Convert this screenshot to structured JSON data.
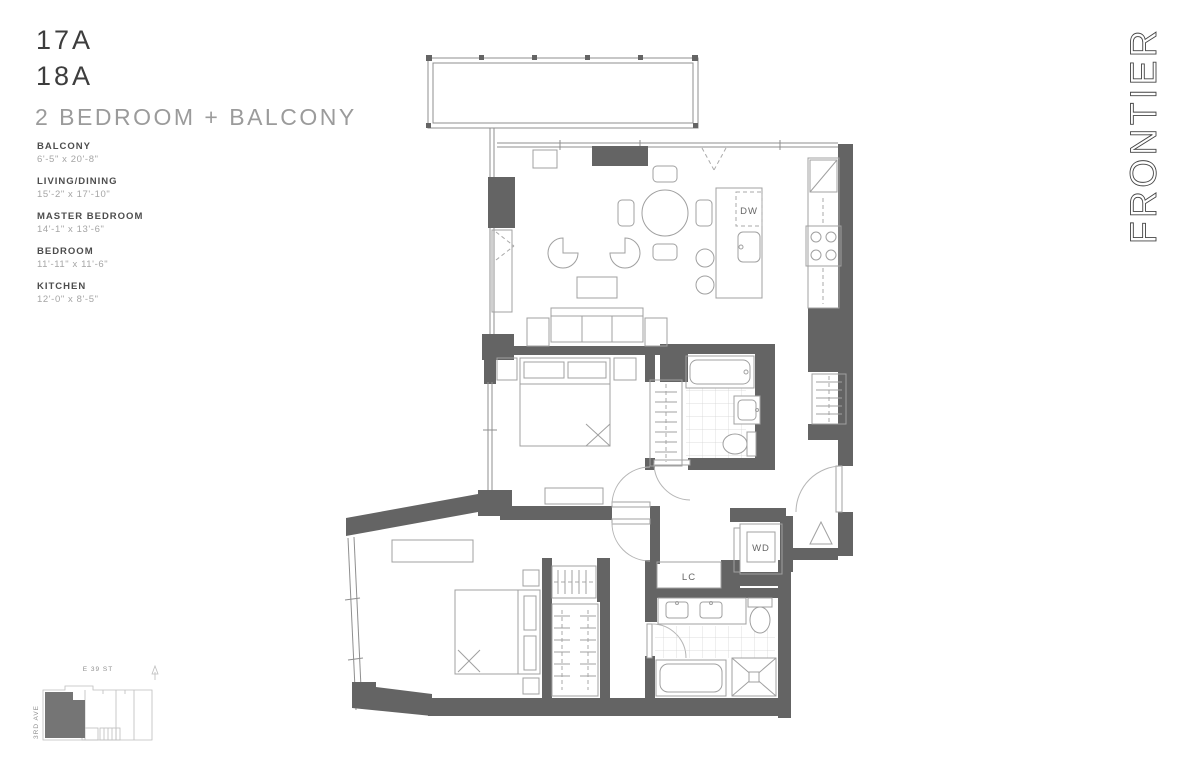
{
  "header": {
    "units": [
      "17A",
      "18A"
    ],
    "title": "2 BEDROOM + BALCONY"
  },
  "room_specs": [
    {
      "name": "BALCONY",
      "dims": "6'-5\" x 20'-8\""
    },
    {
      "name": "LIVING/DINING",
      "dims": "15'-2\" x 17'-10\""
    },
    {
      "name": "MASTER BEDROOM",
      "dims": "14'-1\" x 13'-6\""
    },
    {
      "name": "BEDROOM",
      "dims": "11'-11\" x 11'-6\""
    },
    {
      "name": "KITCHEN",
      "dims": "12'-0\" x 8'-5\""
    }
  ],
  "plan_labels": {
    "dishwasher": "DW",
    "washer_dryer": "WD",
    "linen_closet": "LC"
  },
  "keyplan": {
    "street_top": "E 39 ST",
    "street_left": "3RD AVE"
  },
  "brand": {
    "logo": "FRONTIER"
  },
  "colors": {
    "wall": "#646464",
    "line": "#9a9a9a",
    "text_dark": "#3d3d3d",
    "text_muted": "#9b9b9b"
  }
}
